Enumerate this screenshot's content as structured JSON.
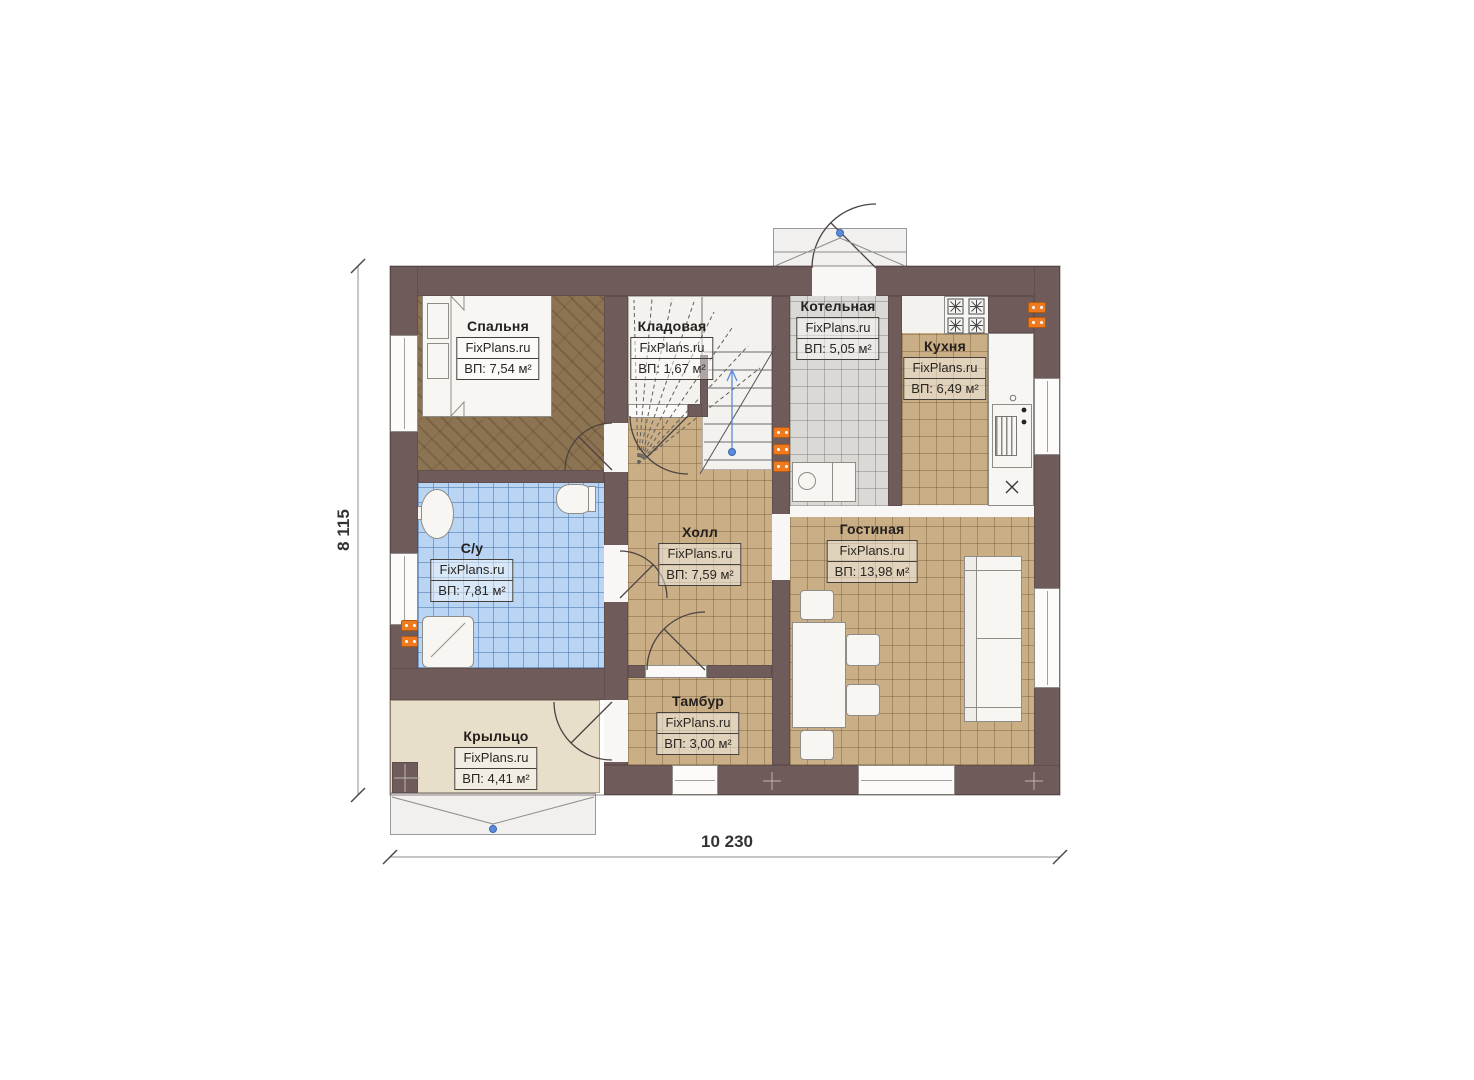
{
  "watermark": "FixPlans.ru",
  "plan_title": "План первого этажа",
  "rooms": [
    {
      "name": "Спальня",
      "area": "ВП: 7,54 м²"
    },
    {
      "name": "Кладовая",
      "area": "ВП: 1,67 м²"
    },
    {
      "name": "Котельная",
      "area": "ВП: 5,05 м²"
    },
    {
      "name": "Кухня",
      "area": "ВП: 6,49 м²"
    },
    {
      "name": "С/у",
      "area": "ВП: 7,81 м²"
    },
    {
      "name": "Холл",
      "area": "ВП: 7,59 м²"
    },
    {
      "name": "Гостиная",
      "area": "ВП: 13,98 м²"
    },
    {
      "name": "Тамбур",
      "area": "ВП: 3,00 м²"
    },
    {
      "name": "Крыльцо",
      "area": "ВП: 4,41 м²"
    }
  ],
  "dimensions": {
    "width_label": "10 230",
    "height_label": "8 115"
  },
  "colors": {
    "wall": "#6e5b5a",
    "floor_tan": "#c9ae86",
    "floor_gray": "#dbd9d6",
    "floor_blue": "#b9d5f3",
    "floor_bedroom": "#8c7352",
    "porch": "#e8dfca",
    "radiator_orange": "#ee7b1f",
    "marker_blue": "#5b8bd8"
  }
}
